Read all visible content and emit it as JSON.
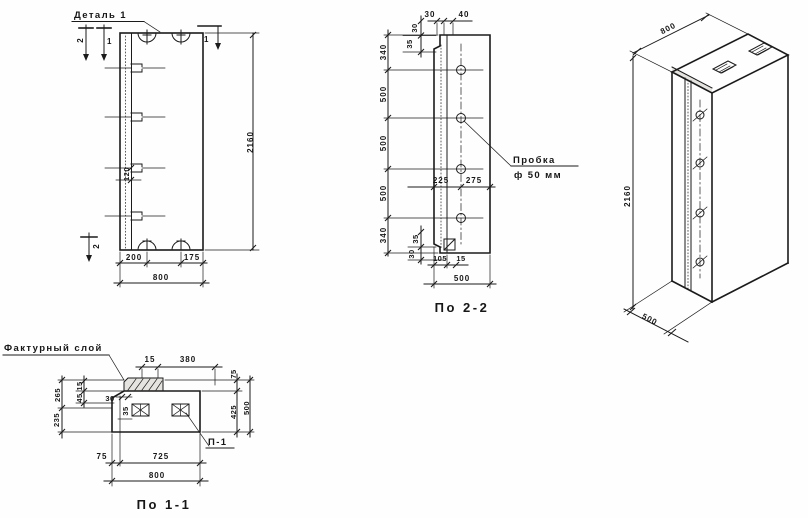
{
  "front": {
    "detail_label": "Деталь 1",
    "flag_outer": "2",
    "flag_inner": "1",
    "flag_right": "1",
    "flag_bottom": "2",
    "dims": {
      "d120": "120",
      "d200": "200",
      "d175": "175",
      "d800": "800",
      "d2160": "2160"
    }
  },
  "sec22": {
    "title": "По 2-2",
    "chain": [
      "340",
      "500",
      "500",
      "500",
      "340"
    ],
    "dims": {
      "t30": "30",
      "t40": "40",
      "tv30": "30",
      "tv35": "35",
      "bv35": "35",
      "bv30": "30",
      "m225": "225",
      "m275": "275",
      "b105": "105",
      "b15": "15",
      "b500": "500"
    },
    "plug": {
      "line1": "Пробка",
      "line2": "ф 50 мм"
    }
  },
  "sec11": {
    "title": "По 1-1",
    "facing_label": "Фактурный слой",
    "plug_ref": "П-1",
    "dims": {
      "t15": "15",
      "t380": "380",
      "l265": "265",
      "l235": "235",
      "l15": "15",
      "l45": "45",
      "l30": "30",
      "l35": "35",
      "r75": "75",
      "r425": "425",
      "r500": "500",
      "b75": "75",
      "b725": "725",
      "b800": "800"
    }
  },
  "iso": {
    "dims": {
      "w800": "800",
      "h2160": "2160",
      "d500": "500"
    }
  },
  "colors": {
    "ink": "#1b1b1b",
    "paper": "#fefefe"
  }
}
